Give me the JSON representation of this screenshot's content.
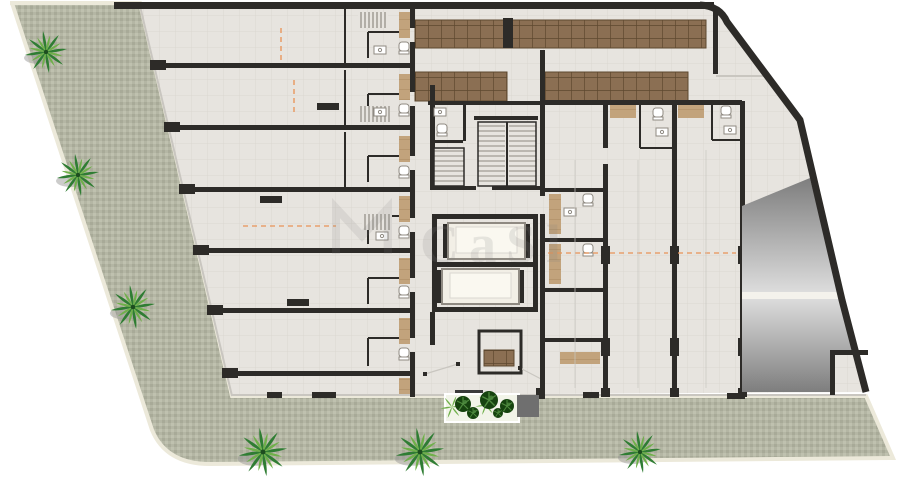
{
  "watermark": {
    "monogram": "M",
    "text": "CaSl"
  },
  "colors": {
    "page": "#ffffff",
    "sidewalk": "#b4b6a4",
    "sidewalk_dark": "#a8aa98",
    "sidewalk_light": "#bfc1af",
    "sidewalk_edge": "#ece9da",
    "floor": "#e7e4df",
    "floor_line": "#dbd7d1",
    "wall": "#2d2b28",
    "thin_line": "#c9c6c0",
    "deck": "#8b6f53",
    "deck_line": "#5e482f",
    "tan": "#c2a37c",
    "tan_line": "#a9885f",
    "ramp_dark": "#7e7e7e",
    "ramp_light": "#dcdcdc",
    "box_gray": "#6f6f6f",
    "palm_dark": "#2f7d33",
    "palm_light": "#6fb04a",
    "palm_shadow": "#9a9a97",
    "bush_dark": "#16430f",
    "bush_light": "#4e8a3e",
    "orange": "#e8955a",
    "fixture": "#ffffff",
    "fixture_stroke": "#8f8a82",
    "planter_bg": "#f2f4e9",
    "mat_dark": "#3a3a3a",
    "watermark": "#808080"
  },
  "site": {
    "palm_trees": [
      {
        "x": 46,
        "y": 52,
        "s": 1.0
      },
      {
        "x": 78,
        "y": 175,
        "s": 1.0
      },
      {
        "x": 133,
        "y": 307,
        "s": 1.05
      },
      {
        "x": 263,
        "y": 452,
        "s": 1.15
      },
      {
        "x": 420,
        "y": 452,
        "s": 1.15
      },
      {
        "x": 640,
        "y": 452,
        "s": 1.0
      }
    ],
    "planter_bushes": [
      {
        "x": 463,
        "y": 404,
        "r": 8
      },
      {
        "x": 489,
        "y": 400,
        "r": 9
      },
      {
        "x": 507,
        "y": 406,
        "r": 7
      },
      {
        "x": 473,
        "y": 413,
        "r": 6
      },
      {
        "x": 498,
        "y": 413,
        "r": 5
      }
    ],
    "planter_sprays": [
      {
        "x": 452,
        "y": 407,
        "s": 0.55
      },
      {
        "x": 486,
        "y": 405,
        "s": 0.5
      }
    ]
  }
}
